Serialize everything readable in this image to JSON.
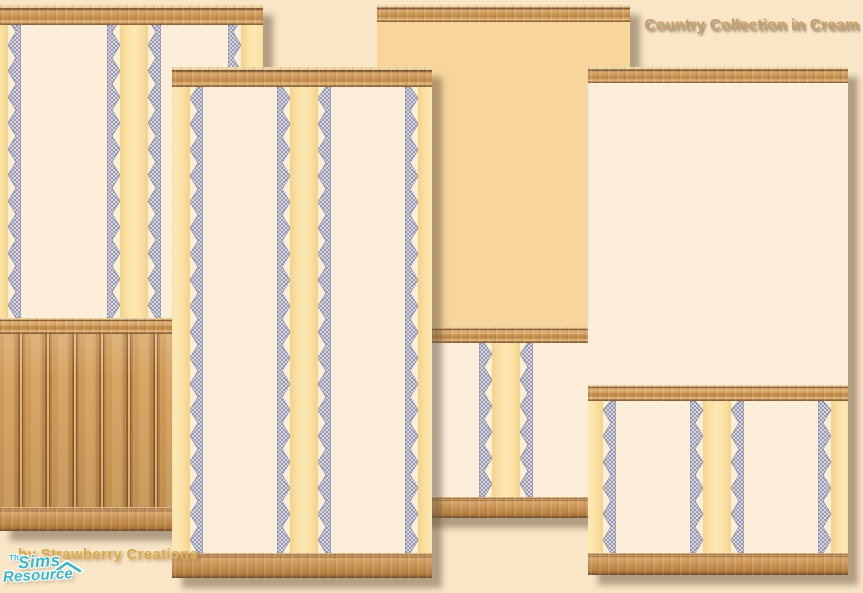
{
  "branding": {
    "collection_title": "Country Collection in Cream",
    "credit": "by Strawberry Creations",
    "logo": {
      "the": "The",
      "sims": "Sims",
      "resource": "Resource"
    }
  },
  "colors": {
    "page_bg": "#f9e6c7",
    "paper_cream": "#fdeeda",
    "paper_tan": "#f7d59c",
    "stripe_yellow": "#fbe1a2",
    "zigzag_mesh_dark": "#9799b1",
    "zigzag_mesh_light": "#d6d7e1",
    "wood_light": "#e2b377",
    "wood_mid": "#c89051",
    "wood_dark": "#8a5c31",
    "title_text": "#c6a067",
    "credit_text": "#d9a94f",
    "logo_teal": "#3cb6c6"
  },
  "zigzag": {
    "strip_width": 13,
    "tooth_period": 26,
    "yellow_width": 28
  },
  "panels": [
    {
      "name": "panel-wainscot-stripes",
      "x": 0,
      "y": 5,
      "w": 263,
      "h": 526,
      "z": 3,
      "sections": [
        {
          "type": "molding",
          "h": 20
        },
        {
          "type": "striped",
          "h": 293,
          "stripes": [
            -33,
            107,
            228
          ]
        },
        {
          "type": "chairrail",
          "h": 16
        },
        {
          "type": "beadboard",
          "h": 173
        },
        {
          "type": "baseboard",
          "h": 24
        }
      ]
    },
    {
      "name": "panel-full-stripes",
      "x": 172,
      "y": 67,
      "w": 260,
      "h": 511,
      "z": 4,
      "sections": [
        {
          "type": "molding",
          "h": 20
        },
        {
          "type": "striped",
          "h": 466,
          "stripes": [
            -23,
            105,
            233
          ]
        },
        {
          "type": "baseboard",
          "h": 25
        }
      ]
    },
    {
      "name": "panel-tan-top-chair-rail",
      "x": 377,
      "y": 5,
      "w": 253,
      "h": 513,
      "z": 1,
      "sections": [
        {
          "type": "molding",
          "h": 17
        },
        {
          "type": "plain-tan",
          "h": 305
        },
        {
          "type": "chairrail",
          "h": 16
        },
        {
          "type": "striped",
          "h": 154,
          "stripes": [
            -26,
            102,
            230
          ]
        },
        {
          "type": "baseboard",
          "h": 21
        }
      ]
    },
    {
      "name": "panel-cream-top-chair-rail",
      "x": 588,
      "y": 67,
      "w": 260,
      "h": 508,
      "z": 2,
      "sections": [
        {
          "type": "molding",
          "h": 16
        },
        {
          "type": "plain-cream",
          "h": 302
        },
        {
          "type": "chairrail",
          "h": 16
        },
        {
          "type": "striped",
          "h": 152,
          "stripes": [
            -26,
            102,
            230
          ]
        },
        {
          "type": "baseboard",
          "h": 22
        }
      ]
    }
  ]
}
